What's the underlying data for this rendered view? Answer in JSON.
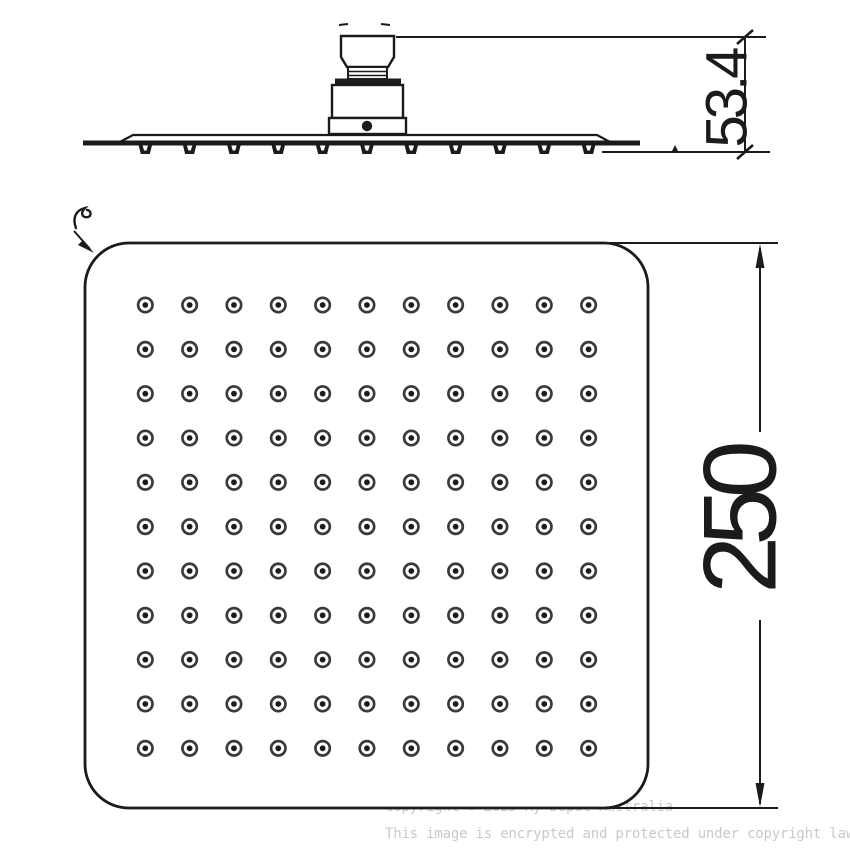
{
  "colors": {
    "ink": "#1b1b1b",
    "nozzle_ring": "#3a3a3a",
    "watermark": "#c9c9c9"
  },
  "side_view": {
    "height_dimension": "53.4",
    "teeth_count": 11
  },
  "face_view": {
    "width_dimension": "250",
    "nozzle_rows": 11,
    "nozzle_cols": 11
  },
  "watermark": {
    "line1": "Copyright © 2025 My Depot Australia",
    "line2": "This image is encrypted and protected under copyright law."
  }
}
